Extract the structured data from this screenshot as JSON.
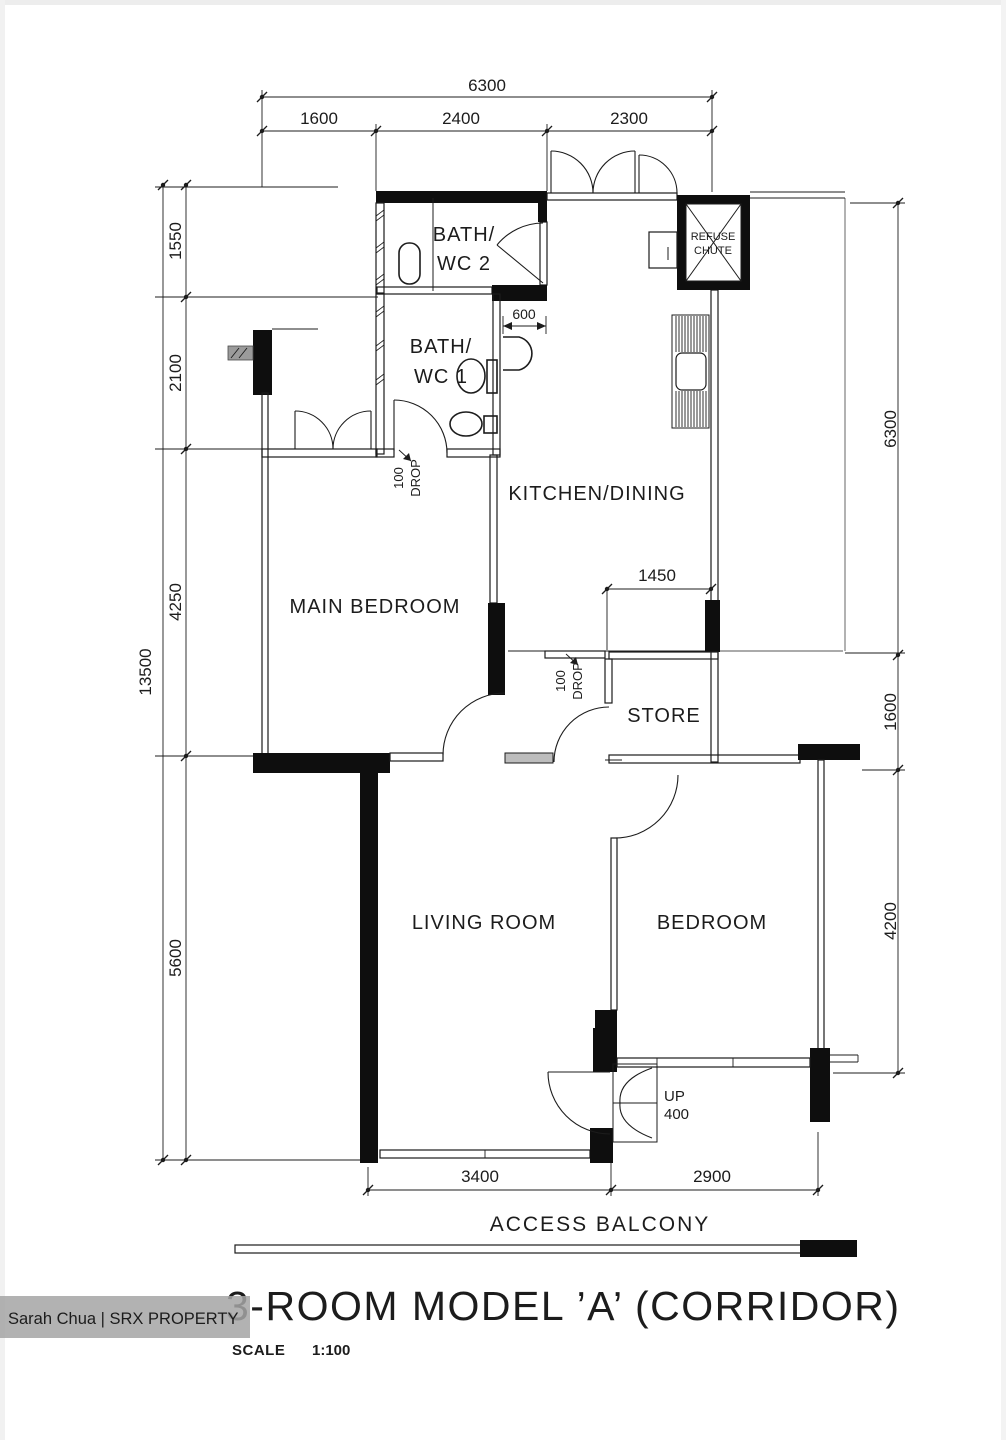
{
  "footer": {
    "title": "3-ROOM MODEL ’A’ (CORRIDOR)",
    "scale_label": "SCALE",
    "scale_value": "1:100"
  },
  "watermark": {
    "text": "Sarah Chua | SRX PROPERTY"
  },
  "rooms": {
    "bath_wc2": {
      "line1": "BATH/",
      "line2": "WC 2"
    },
    "bath_wc1": {
      "line1": "BATH/",
      "line2": "WC 1"
    },
    "kitchen": {
      "label": "KITCHEN/DINING"
    },
    "main_bedroom": {
      "label": "MAIN BEDROOM"
    },
    "store": {
      "label": "STORE"
    },
    "living": {
      "label": "LIVING ROOM"
    },
    "bedroom": {
      "label": "BEDROOM"
    },
    "refuse": {
      "line1": "REFUSE",
      "line2": "CHUTE"
    }
  },
  "annotations": {
    "access_balcony": "ACCESS BALCONY",
    "up": "UP",
    "up_value": "400",
    "drop_value": "100",
    "drop_word": "DROP"
  },
  "dimensions": {
    "top_total": "6300",
    "top_segments": [
      "1600",
      "2400",
      "2300"
    ],
    "left_total": "13500",
    "left_segments": [
      "1550",
      "2100",
      "4250",
      "5600"
    ],
    "right_segments": [
      "6300",
      "1600",
      "4200"
    ],
    "bottom_segments": [
      "3400",
      "2900"
    ],
    "door_width": "600",
    "kitchen_opening": "1450"
  },
  "colors": {
    "ink": "#1c1c1c",
    "wall": "#0e0e0e",
    "paper": "#ffffff",
    "watermark_bg": "#a5a5a5",
    "watermark_text": "#ffffff"
  }
}
